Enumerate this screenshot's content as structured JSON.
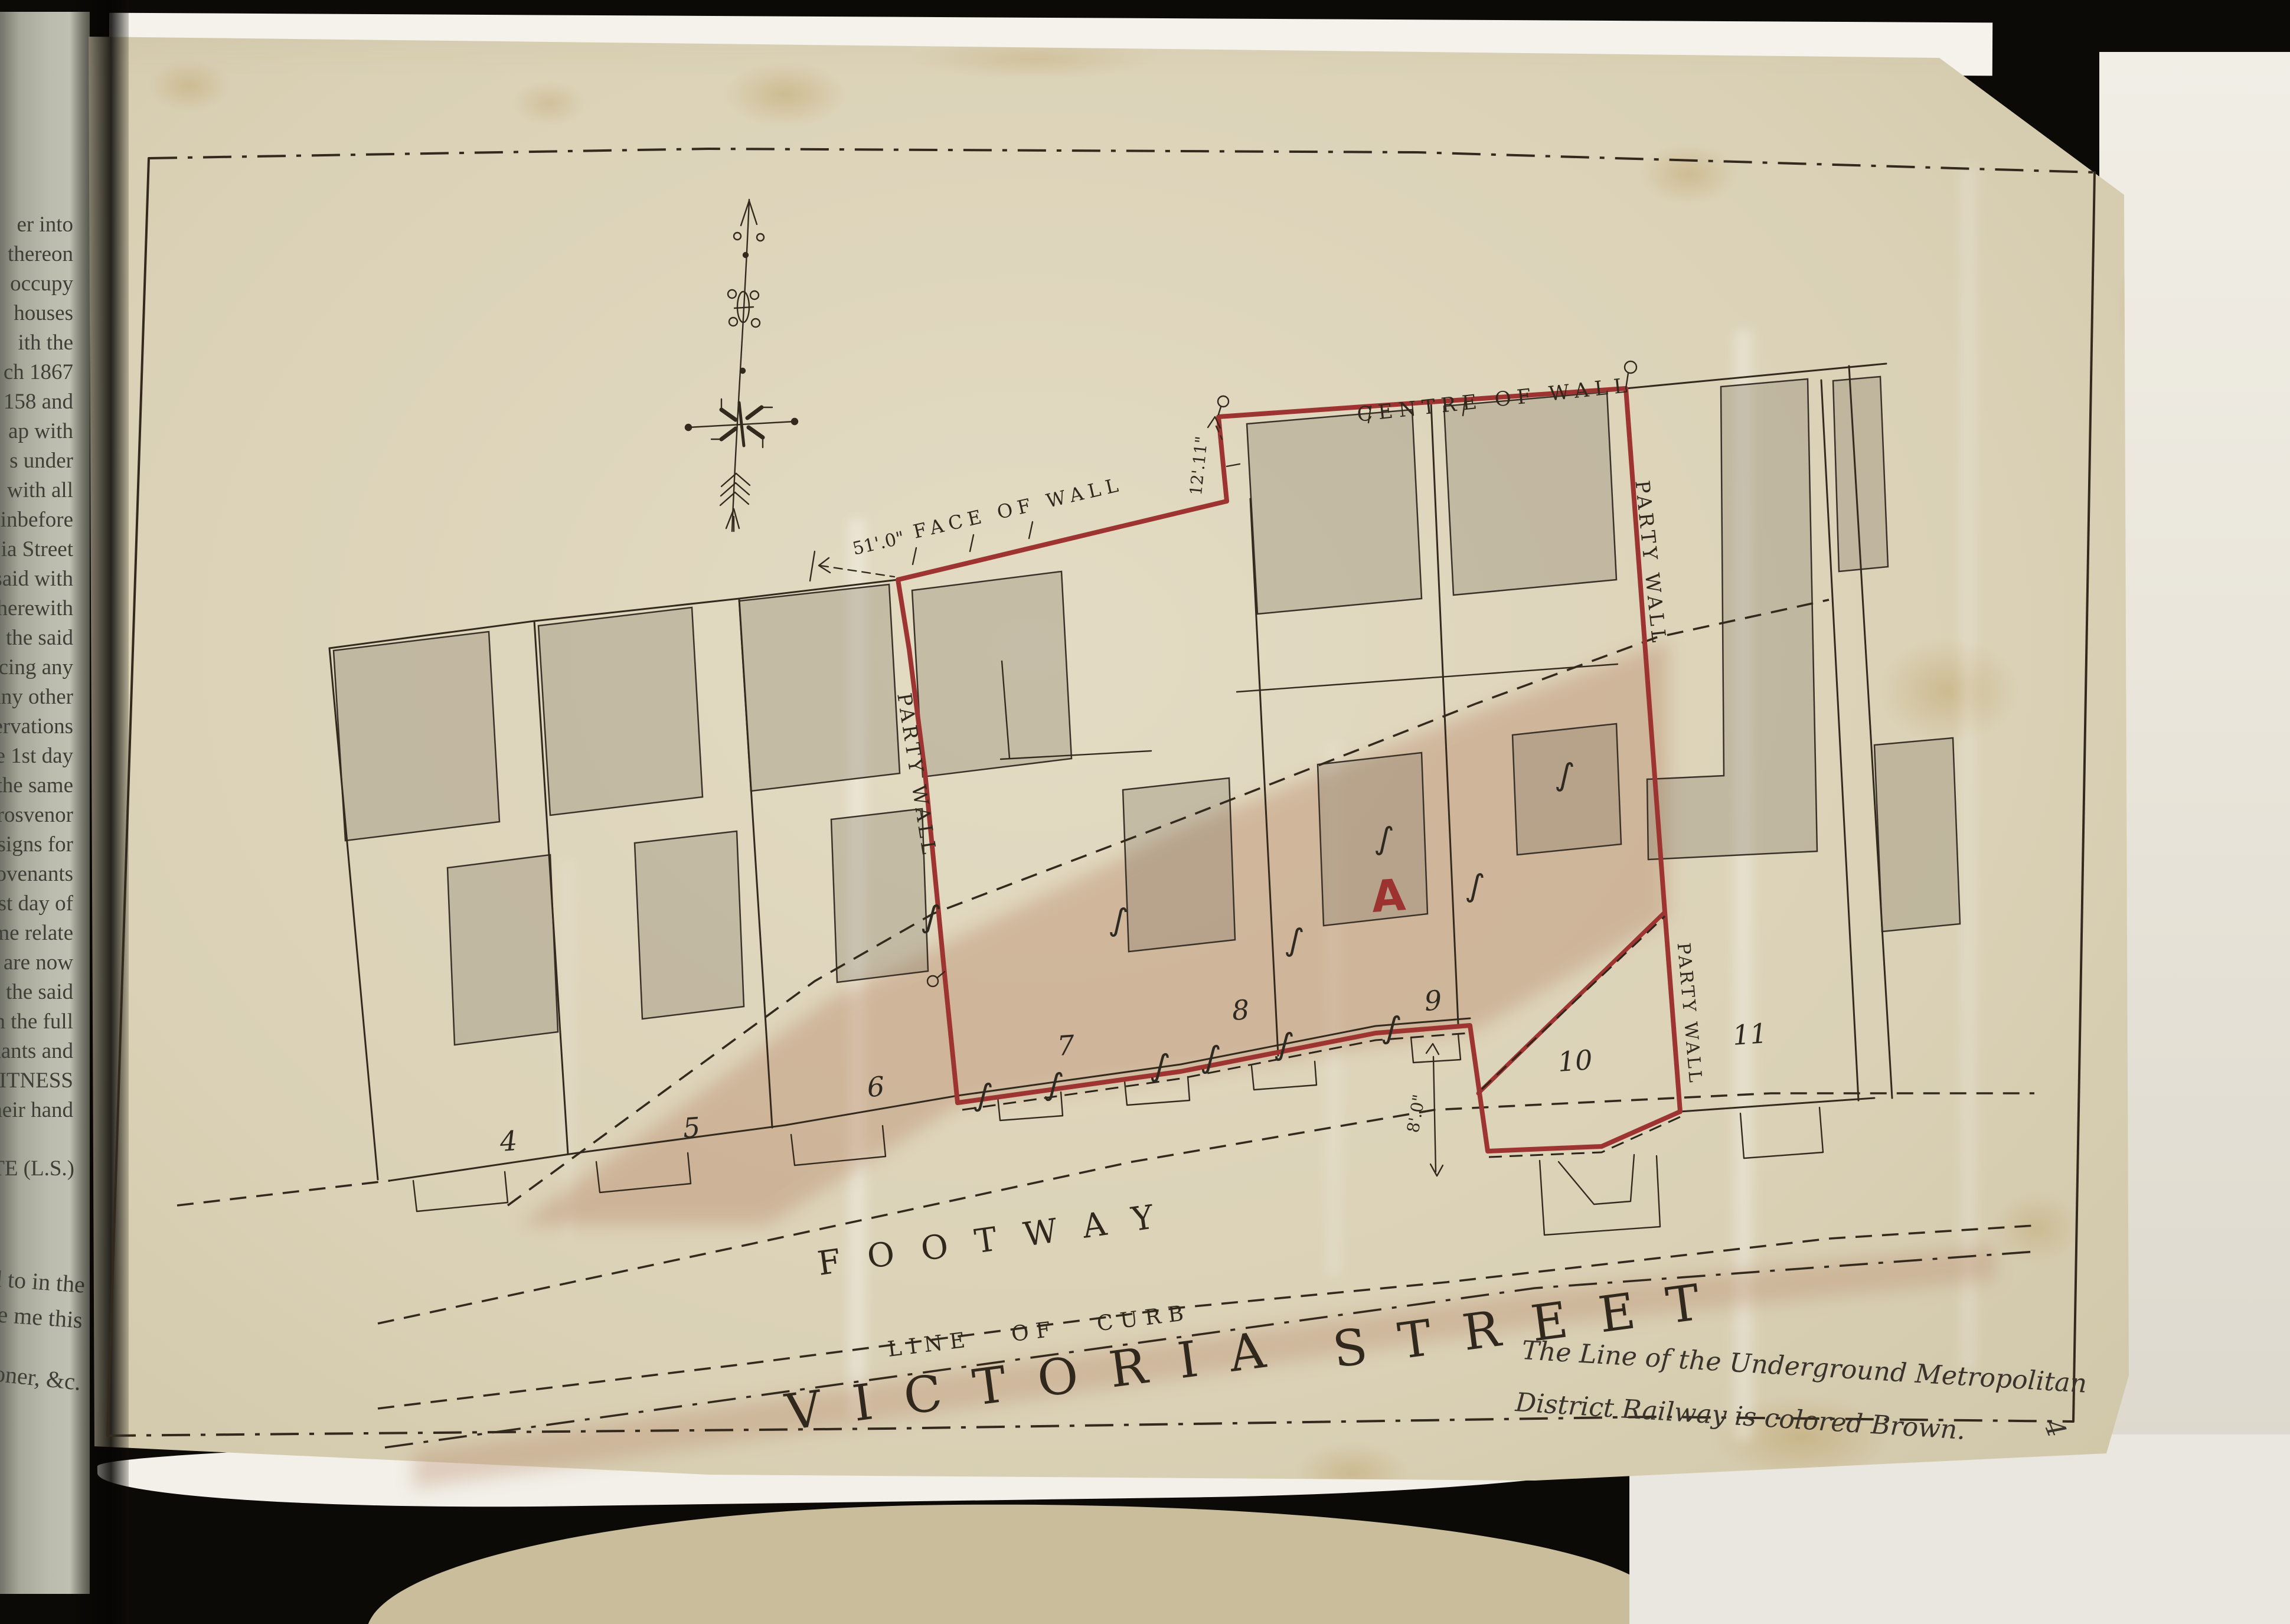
{
  "book_page": {
    "fragments": [
      "er into",
      "thereon",
      "occupy",
      "houses",
      "ith the",
      "ch 1867",
      "158 and",
      "ap with",
      "s under",
      "with all",
      "einbefore",
      "ia Street",
      "said with",
      "herewith",
      "the said",
      "rcing any",
      "any other",
      "servations",
      "e 1st day",
      "the same",
      "Grosvenor",
      "assigns for",
      "covenants",
      "1st day of",
      "ame relate",
      "are now",
      "o the said",
      "h the full",
      "enants and",
      "WITNESS",
      "their hand"
    ],
    "seal": "TE (L.S.)",
    "fragments_lower": [
      "ed to in the",
      "fore me this"
    ],
    "fragment_officer": "ssioner, &c."
  },
  "plan": {
    "labels": {
      "centre_of_wall": "CENTRE OF WALL",
      "face_of_wall": "FACE OF WALL",
      "dim_face": "51'.0\"",
      "dim_notch": "12'.11\"",
      "dim_footway": "8'.0\"",
      "party_wall_left": "PARTY WALL",
      "party_wall_right_upper": "PARTY WALL",
      "party_wall_right_lower": "PARTY WALL",
      "parcel_letter": "A",
      "footway": "FOOTWAY",
      "line_of_curb": "LINE OF CURB",
      "victoria": "VICTORIA",
      "street": "STREET",
      "s_mark": "∫",
      "corner_mark": "4"
    },
    "plot_numbers": [
      "4",
      "5",
      "6",
      "7",
      "8",
      "9",
      "10",
      "11"
    ],
    "note": {
      "line1": "The Line of the Underground Metropolitan",
      "line2": "District Railway is colored Brown."
    },
    "colors": {
      "boundary_red": "#9e3431",
      "railway_brown": "#b9886a",
      "ink": "#33291d"
    }
  }
}
